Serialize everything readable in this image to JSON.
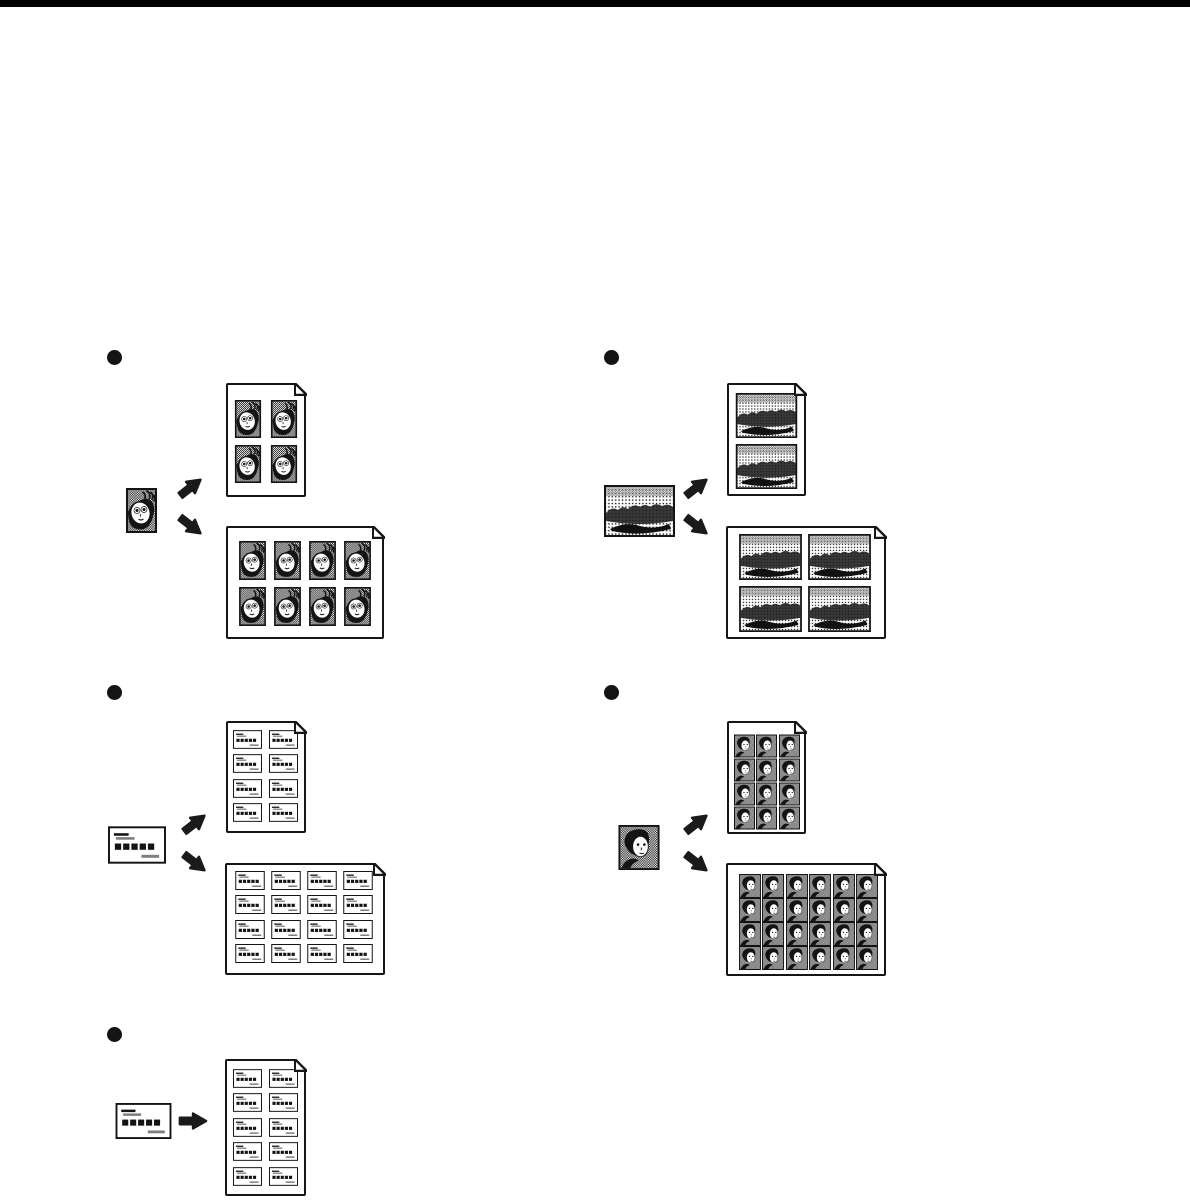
{
  "page": {
    "background_color": "#ffffff",
    "ink_color": "#161616",
    "top_bar_color": "#000000",
    "bullet_style": "filled-circle"
  },
  "sections": [
    {
      "name": "portrait-photo-repeat",
      "source": {
        "icon": "portrait-photo-thumbnail",
        "item": "photo-portrait"
      },
      "arrows": [
        {
          "icon": "arrow-up-right"
        },
        {
          "icon": "arrow-down-right"
        }
      ],
      "outputs": [
        {
          "sheet_orientation": "portrait",
          "rows": 2,
          "cols": 2,
          "copies": 4,
          "item": "photo-portrait"
        },
        {
          "sheet_orientation": "landscape",
          "rows": 2,
          "cols": 4,
          "copies": 8,
          "item": "photo-portrait"
        }
      ]
    },
    {
      "name": "landscape-photo-repeat",
      "source": {
        "icon": "landscape-photo-thumbnail",
        "item": "photo-landscape"
      },
      "arrows": [
        {
          "icon": "arrow-up-right"
        },
        {
          "icon": "arrow-down-right"
        }
      ],
      "outputs": [
        {
          "sheet_orientation": "portrait",
          "rows": 2,
          "cols": 1,
          "copies": 2,
          "item": "photo-landscape"
        },
        {
          "sheet_orientation": "landscape",
          "rows": 2,
          "cols": 2,
          "copies": 4,
          "item": "photo-landscape"
        }
      ]
    },
    {
      "name": "business-card-repeat",
      "source": {
        "icon": "business-card-thumbnail",
        "item": "business-card"
      },
      "arrows": [
        {
          "icon": "arrow-up-right"
        },
        {
          "icon": "arrow-down-right"
        }
      ],
      "outputs": [
        {
          "sheet_orientation": "portrait",
          "rows": 4,
          "cols": 2,
          "copies": 8,
          "item": "business-card"
        },
        {
          "sheet_orientation": "landscape",
          "rows": 4,
          "cols": 4,
          "copies": 16,
          "item": "business-card"
        }
      ]
    },
    {
      "name": "id-photo-repeat",
      "source": {
        "icon": "id-photo-thumbnail",
        "item": "photo-id"
      },
      "arrows": [
        {
          "icon": "arrow-up-right"
        },
        {
          "icon": "arrow-down-right"
        }
      ],
      "outputs": [
        {
          "sheet_orientation": "portrait",
          "rows": 4,
          "cols": 3,
          "copies": 12,
          "item": "photo-id"
        },
        {
          "sheet_orientation": "landscape",
          "rows": 4,
          "cols": 6,
          "copies": 24,
          "item": "photo-id"
        }
      ]
    },
    {
      "name": "business-card-repeat-tall-sheet",
      "source": {
        "icon": "business-card-thumbnail",
        "item": "business-card"
      },
      "arrows": [
        {
          "icon": "arrow-right"
        }
      ],
      "outputs": [
        {
          "sheet_orientation": "portrait",
          "rows": 5,
          "cols": 2,
          "copies": 10,
          "item": "business-card"
        }
      ]
    }
  ]
}
